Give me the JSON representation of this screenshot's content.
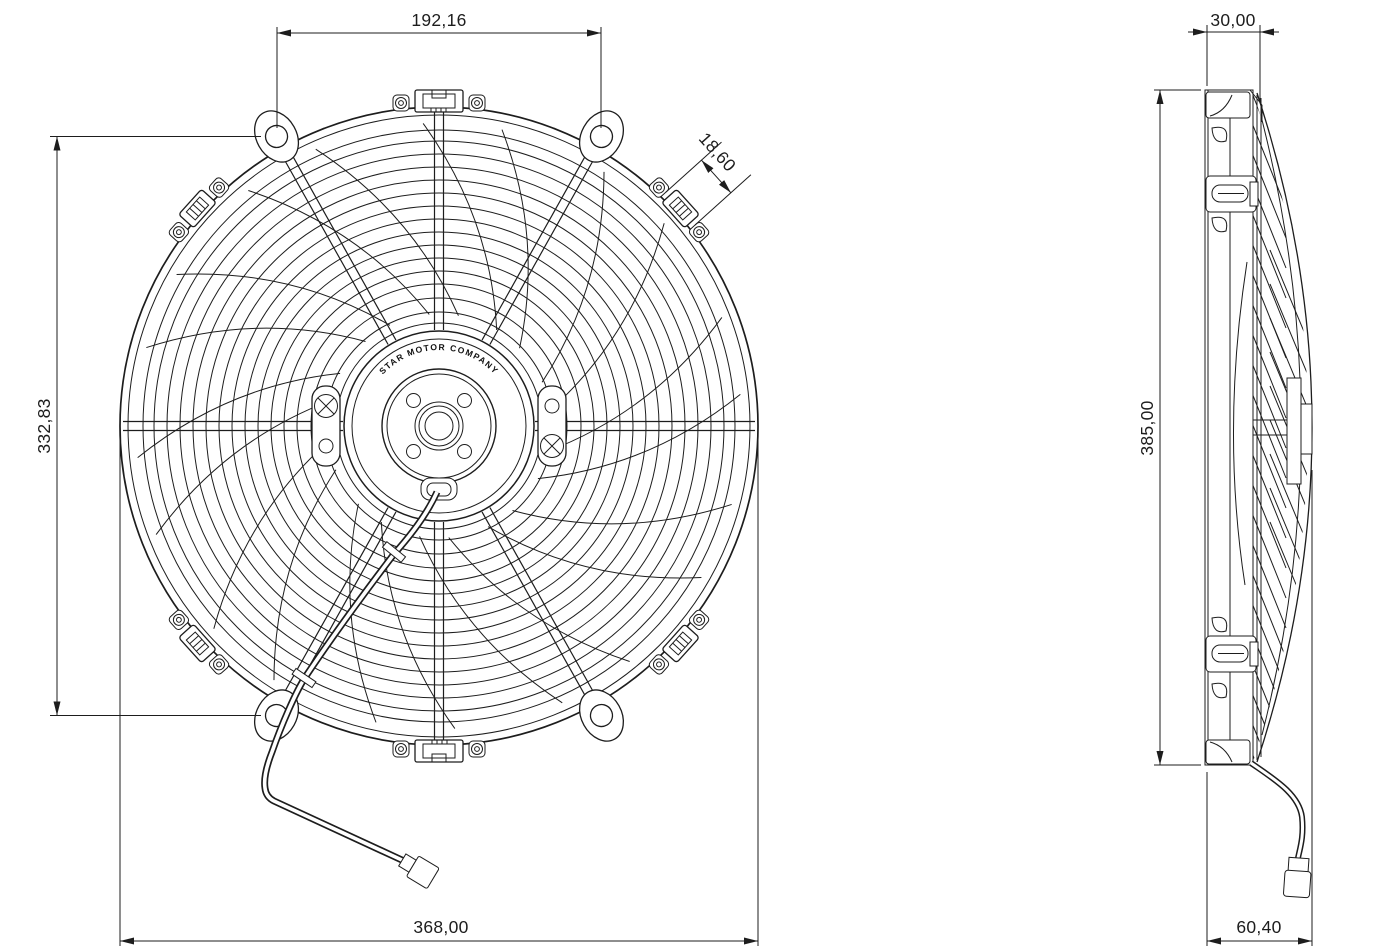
{
  "front_view": {
    "hub_label": "STAR MOTOR COMPANY",
    "dim_top_width": "192,16",
    "dim_clip": "18,60",
    "dim_left_height": "332,83",
    "dim_bottom_width": "368,00"
  },
  "side_view": {
    "dim_top_depth": "30,00",
    "dim_height": "385,00",
    "dim_bottom_depth": "60,40"
  },
  "colors": {
    "line": "#1d1d1d",
    "background": "#ffffff"
  }
}
